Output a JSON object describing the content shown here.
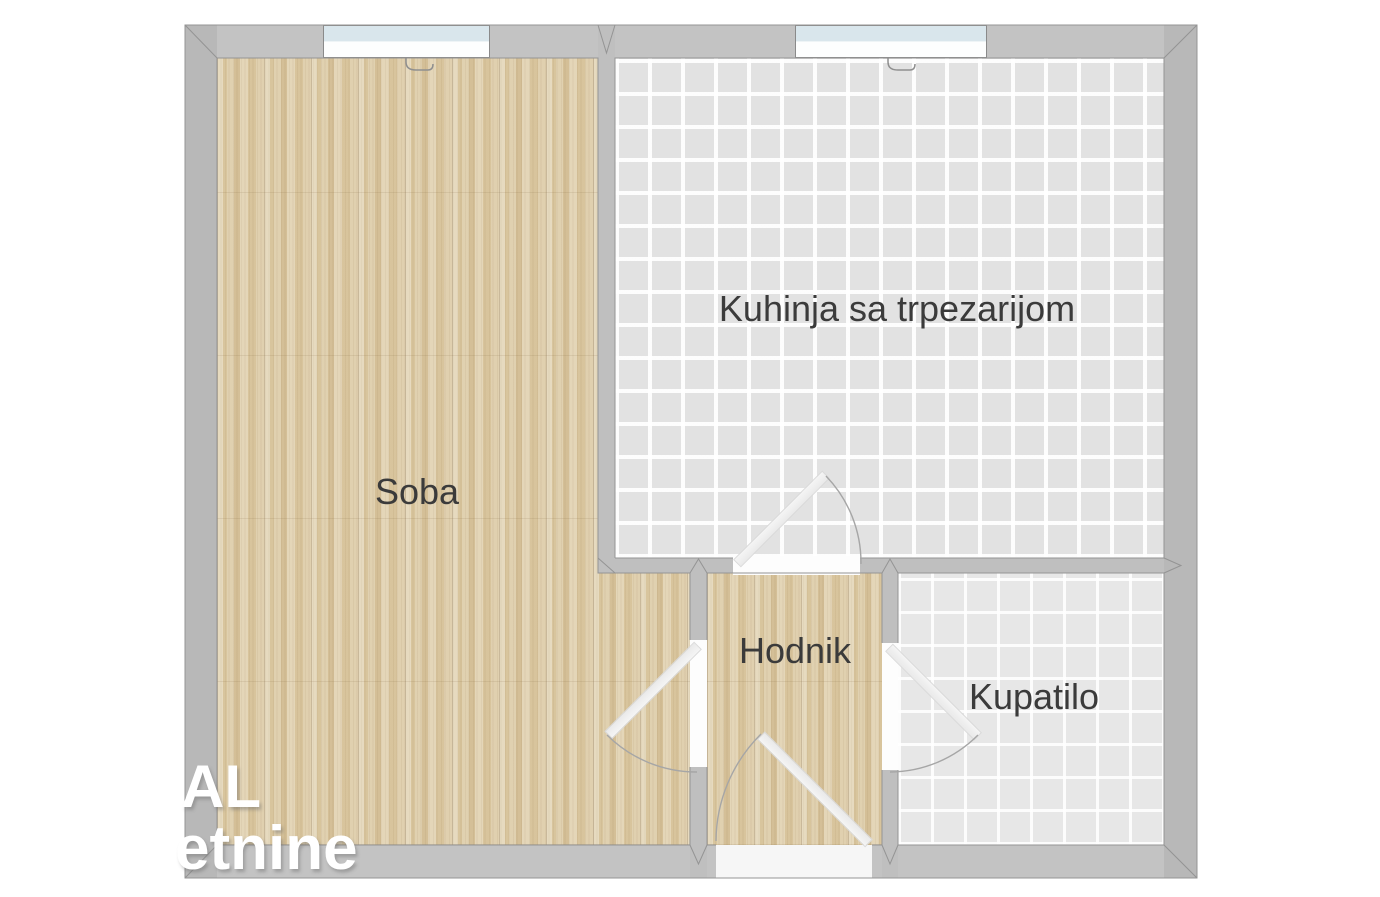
{
  "floorplan": {
    "rooms": {
      "soba": {
        "label": "Soba"
      },
      "kuhinja": {
        "label": "Kuhinja sa trpezarijom"
      },
      "hodnik": {
        "label": "Hodnik"
      },
      "kupatilo": {
        "label": "Kupatilo"
      }
    },
    "watermark": {
      "line1": "AL",
      "line2": "etnine"
    },
    "colors": {
      "background": "#ffffff",
      "wall": "#bfbfbf",
      "wall_outline": "#949494",
      "wood_floor": "#dccaa4",
      "kitchen_tile": "#e2e2e2",
      "bath_tile": "#e7e7e7",
      "tile_grout": "#f7f7f7",
      "window_glass": "#d9e6ec",
      "door_arc": "#a6a6a6",
      "label_text": "#3b3b3b",
      "watermark_text": "#ffffff"
    }
  }
}
